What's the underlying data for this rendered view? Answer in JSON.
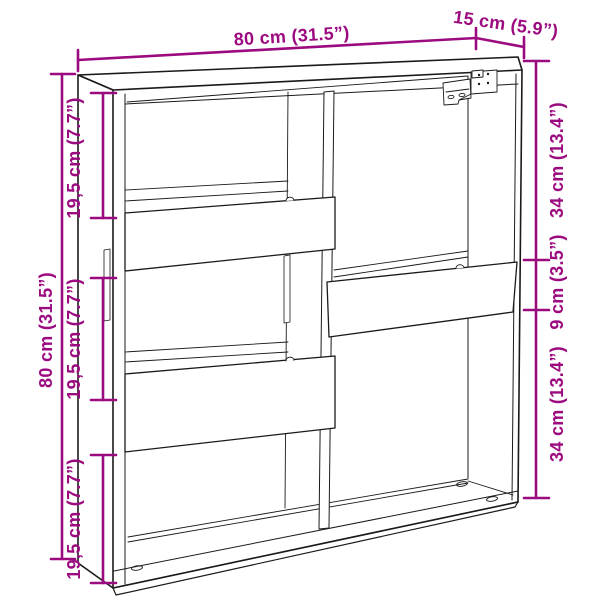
{
  "colors": {
    "dimension": "#9C0A80",
    "line": "#1A1A1A",
    "background": "#FFFFFF"
  },
  "dimensions": {
    "top_width": "80 cm (31.5”)",
    "top_depth": "15 cm (5.9”)",
    "left_total_height": "80 cm (31.5”)",
    "left_compartments": [
      "19,5 cm (7.7”)",
      "19,5 cm (7.7”)",
      "19,5 cm (7.7”)"
    ],
    "right_top": "34 cm (13.4”)",
    "right_middle": "9 cm (3.5”)",
    "right_bottom": "34 cm (13.4”)"
  }
}
